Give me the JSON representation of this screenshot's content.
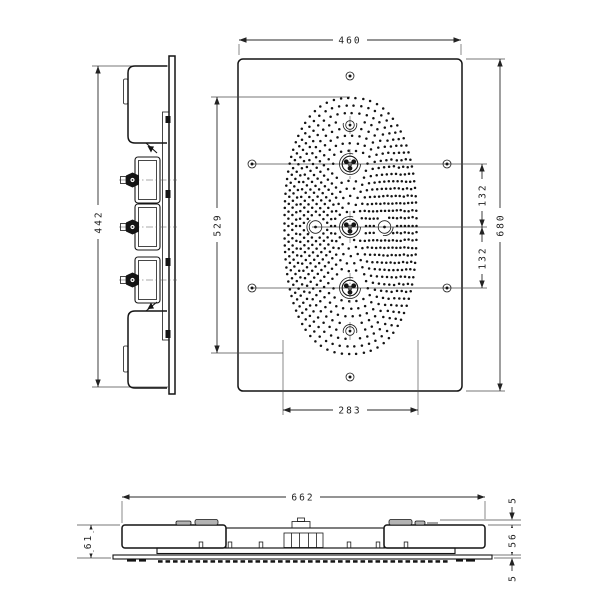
{
  "drawing": {
    "kind": "technical-dimension-drawing",
    "views": {
      "front": {
        "label": "front-view",
        "dims": {
          "width": "460",
          "height": "680",
          "spray_field_height": "529",
          "spray_field_width": "283",
          "spacing_upper": "132",
          "spacing_lower": "132"
        }
      },
      "side": {
        "label": "side-view",
        "dims": {
          "height": "442"
        }
      },
      "bottom": {
        "label": "bottom-view",
        "dims": {
          "width": "662",
          "total_depth": "61",
          "clip_height": "5",
          "housing_depth": "56",
          "panel_thickness": "5"
        }
      }
    },
    "line_color": "#141414",
    "background": "#ffffff"
  }
}
